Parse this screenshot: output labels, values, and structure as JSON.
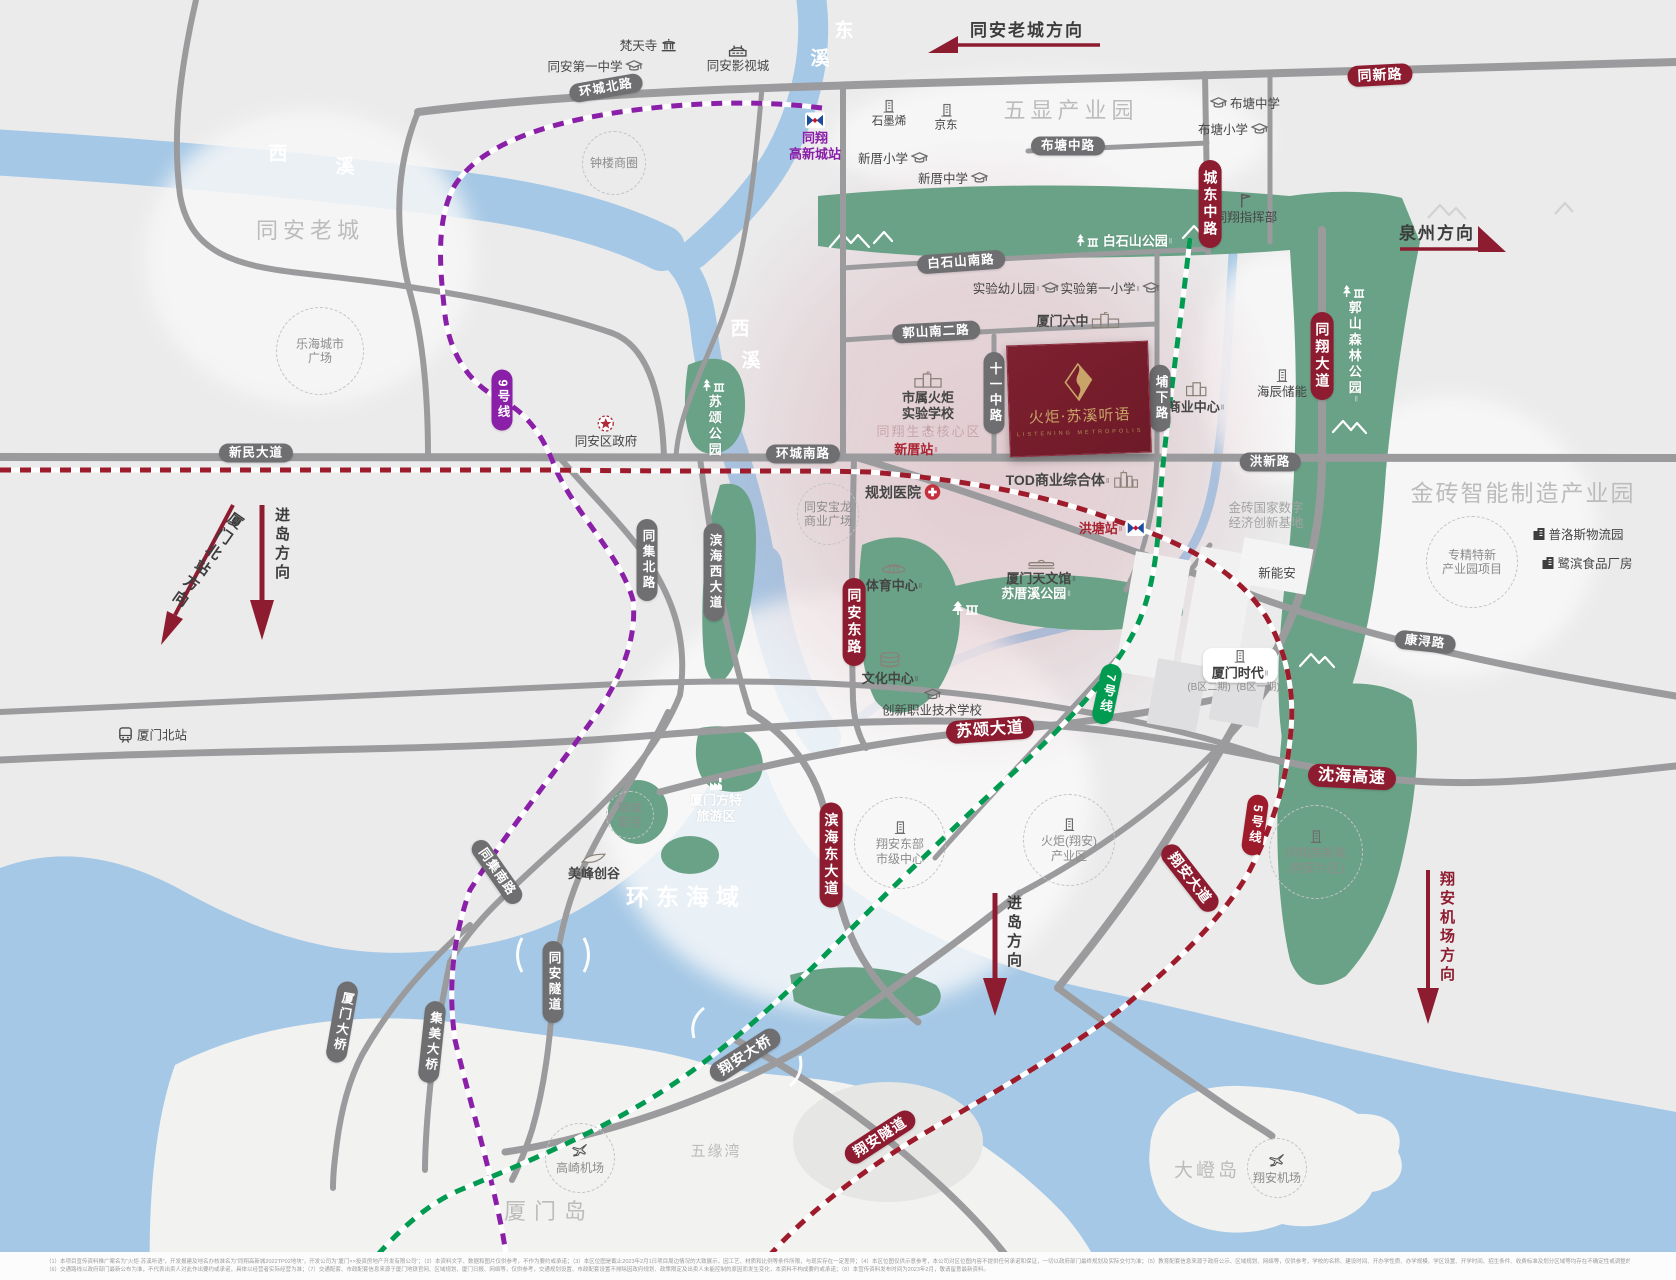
{
  "project": {
    "billboard_title": "火炬·苏溪听语",
    "billboard_subtitle": "LISTENING METROPOLIS"
  },
  "colors": {
    "accent_red": "#8E1C30",
    "road_gray": "#9B9B9D",
    "pill_gray": "#6F6F72",
    "metro9_purple": "#8A1FA8",
    "metro7_green": "#009A50",
    "metro5_red": "#9E1B2B",
    "park_green": "#6AA287",
    "water_blue": "#A5C8E6",
    "pink_zone": "#CD8794"
  },
  "disclaimer": {
    "line1": "（1）本项目宣传资料推广案名为“火炬·苏溪听语”，开发报建及地名办核准名为“同翔高新城2022TP02地块”，开发公司为“厦门××投资房地产开发有限公司”；（2）本资料文字、数据和图片仅供参考，不作为要约或承诺；（3）本区位图是截止2023年2月1日项目周边情况的大致展示，因工艺、材质和比例等条件所限，与现实存在一定差异；（4）本区位图仅供示意参考，本公司对区位图内容不提供任何承诺和保证，一切以政府部门最终规划及实际交付为准；（5）教育配套信息来源于政府公示、区域规划、网络等，仅供参考，学校的名称、建设时间、开办学性质、办学规模、学区设置、开学时间、招生条件、收费标准及划分区域等均存在不确定性或调整的可能，出卖人对此不做任何承诺。",
    "line2": "（6）交通路线以政府部门最新公布为准，不代表出卖人对此作出要约或承诺，具体以经营者实际经营为准；（7）交通配套、市政配套信息来源于厦门地铁官网、区域规划、厦门日报、网络等，仅供参考，交通规划设置、市政配套设置不排除因政府规划、政策限定及出卖人未能控制的原因而发生变化，本资料不构成要约或承诺；（8）本宣传资料发布时间为2023年2月，敬请留意最新资料。"
  },
  "labels": [
    {
      "name": "river-xixi-char1",
      "t": "西",
      "x": 278,
      "y": 155,
      "cls": "riverchar"
    },
    {
      "name": "river-xixi-char2",
      "t": "溪",
      "x": 345,
      "y": 168,
      "cls": "riverchar"
    },
    {
      "name": "river-dongxi-char1",
      "t": "东",
      "x": 844,
      "y": 32,
      "cls": "riverchar"
    },
    {
      "name": "river-dongxi-char2",
      "t": "溪",
      "x": 820,
      "y": 60,
      "cls": "riverchar"
    },
    {
      "name": "river-xixi-south-char1",
      "t": "西",
      "x": 740,
      "y": 330,
      "cls": "riverchar"
    },
    {
      "name": "river-xixi-south-char2",
      "t": "溪",
      "x": 751,
      "y": 362,
      "cls": "riverchar"
    },
    {
      "name": "area-tongan-oldtown",
      "t": "同安老城",
      "x": 310,
      "y": 231,
      "cls": "arealg"
    },
    {
      "name": "area-wuxian-park",
      "t": "五显产业园",
      "x": 1071,
      "y": 111,
      "cls": "arealg"
    },
    {
      "name": "area-jinzhuan-park",
      "t": "金砖智能制造产业园",
      "x": 1523,
      "y": 494,
      "cls": "arealg",
      "fs": 23,
      "ls": 2
    },
    {
      "name": "area-huandong-bay",
      "t": "环东海域",
      "x": 686,
      "y": 898,
      "cls": "sealg"
    },
    {
      "name": "area-xiamen-island",
      "t": "厦门岛",
      "x": 549,
      "y": 1212,
      "cls": "arealg",
      "ls": 8
    },
    {
      "name": "area-dadeng-island",
      "t": "大嶝岛",
      "x": 1207,
      "y": 1172,
      "cls": "arealg",
      "fs": 19,
      "ls": 3
    },
    {
      "name": "area-wuyuan-bay",
      "t": "五缘湾",
      "x": 716,
      "y": 1152,
      "cls": "arealg",
      "fs": 15,
      "ls": 2
    },
    {
      "name": "poi-fantian-temple",
      "t": "梵天寺",
      "x": 648,
      "y": 46,
      "icon": "temple",
      "ip": "right"
    },
    {
      "name": "poi-film-city",
      "t": "同安影视城",
      "x": 738,
      "y": 59,
      "icon": "studio",
      "ip": "top"
    },
    {
      "name": "poi-tongan-no1-school",
      "t": "同安第一中学",
      "x": 595,
      "y": 67,
      "icon": "school",
      "ip": "right"
    },
    {
      "name": "station-tongxiang-hitech",
      "lines": [
        "同翔",
        "高新城站"
      ],
      "x": 815,
      "y": 137,
      "cls": "poi-purple",
      "icon": "metro",
      "ip": "top"
    },
    {
      "name": "poi-graphene",
      "t": "石墨烯",
      "x": 889,
      "y": 114,
      "cls": "sm",
      "icon": "building",
      "ip": "top"
    },
    {
      "name": "poi-jd",
      "t": "京东",
      "x": 946,
      "y": 118,
      "cls": "sm",
      "icon": "building",
      "ip": "top"
    },
    {
      "name": "poi-xincuo-primary",
      "t": "新厝小学",
      "x": 893,
      "y": 159,
      "icon": "school",
      "ip": "right"
    },
    {
      "name": "poi-xincuo-middle",
      "t": "新厝中学",
      "x": 953,
      "y": 179,
      "icon": "school",
      "ip": "right"
    },
    {
      "name": "poi-butang-middle",
      "t": "布塘中学",
      "x": 1245,
      "y": 104,
      "icon": "school",
      "ip": "left"
    },
    {
      "name": "poi-butang-primary",
      "t": "布塘小学",
      "x": 1233,
      "y": 130,
      "icon": "school",
      "ip": "right"
    },
    {
      "name": "poi-tongxiang-hq",
      "t": "同翔指挥部",
      "x": 1246,
      "y": 209,
      "icon": "flag",
      "ip": "top"
    },
    {
      "name": "poi-baishishan-park",
      "t": "白石山公园",
      "x": 1124,
      "y": 241,
      "cls": "wl",
      "icon": "park",
      "ip": "left",
      "sup": 1
    },
    {
      "name": "poi-shiyan-kindergarten",
      "t": "实验幼儿园",
      "x": 1016,
      "y": 289,
      "icon": "school",
      "ip": "right",
      "sup": 1
    },
    {
      "name": "poi-shiyan-first-primary",
      "t": "实验第一小学",
      "x": 1110,
      "y": 289,
      "icon": "school",
      "ip": "right",
      "sup": 1
    },
    {
      "name": "poi-xiamen-no6",
      "t": "厦门六中",
      "x": 1078,
      "y": 321,
      "cls": "b",
      "icon": "schoolbldg",
      "ip": "right"
    },
    {
      "name": "poi-torch-school",
      "lines": [
        "市属火炬",
        "实验学校"
      ],
      "x": 928,
      "y": 404,
      "cls": "b",
      "icon": "schoolbldg",
      "ip": "top",
      "sup": 1
    },
    {
      "name": "label-eco-core",
      "t": "同翔生态核心区",
      "x": 929,
      "y": 432,
      "cls": "core"
    },
    {
      "name": "station-xincuo",
      "t": "新厝站",
      "x": 916,
      "y": 450,
      "cls": "station",
      "sup": 1
    },
    {
      "name": "poi-business-center",
      "t": "商业中心",
      "x": 1196,
      "y": 398,
      "cls": "b",
      "icon": "building2",
      "ip": "top",
      "sup": 1
    },
    {
      "name": "poi-haichen-storage",
      "t": "海辰储能",
      "x": 1282,
      "y": 384,
      "icon": "building",
      "ip": "top"
    },
    {
      "name": "poi-guoshan-forest-park",
      "t": "郭山森林公园",
      "x": 1354,
      "y": 345,
      "cls": "wl v",
      "icon": "park",
      "ip": "top",
      "sup": 1
    },
    {
      "name": "poi-susong-park",
      "t": "苏颂公园",
      "x": 714,
      "y": 418,
      "cls": "wl v",
      "icon": "park",
      "ip": "top"
    },
    {
      "name": "poi-tod-complex",
      "t": "TOD商业综合体",
      "x": 1072,
      "y": 480,
      "cls": "b",
      "fs": 14,
      "icon": "tod",
      "ip": "right",
      "sup": 1
    },
    {
      "name": "station-hongtang",
      "t": "洪塘站",
      "x": 1112,
      "y": 529,
      "cls": "station",
      "icon": "metro",
      "ip": "right",
      "sup": 1
    },
    {
      "name": "poi-planned-hospital",
      "t": "规划医院",
      "x": 903,
      "y": 493,
      "cls": "b",
      "fs": 14,
      "icon": "cross",
      "ip": "right"
    },
    {
      "name": "poi-sports-center",
      "t": "体育中心",
      "x": 894,
      "y": 577,
      "cls": "b",
      "icon": "stadium",
      "ip": "top",
      "sup": 1
    },
    {
      "name": "poi-planetarium",
      "t": "厦门天文馆",
      "x": 1041,
      "y": 572,
      "cls": "b",
      "icon": "observatory",
      "ip": "top",
      "sup": 1
    },
    {
      "name": "poi-sucuoxi-park",
      "t": "苏厝溪公园",
      "x": 1036,
      "y": 594,
      "cls": "wl",
      "sup": 1
    },
    {
      "name": "poi-culture-center",
      "t": "文化中心",
      "x": 890,
      "y": 669,
      "cls": "b",
      "icon": "cylinder",
      "ip": "top",
      "sup": 1
    },
    {
      "name": "poi-vocational-school",
      "t": "创新职业技术学校",
      "x": 932,
      "y": 703,
      "icon": "school",
      "ip": "top"
    },
    {
      "name": "label-brics-base",
      "lines": [
        "金砖国家数字",
        "经济创新基地"
      ],
      "x": 1266,
      "y": 516,
      "cls": "ghost"
    },
    {
      "name": "poi-prologis",
      "t": "普洛斯物流园",
      "x": 1578,
      "y": 535,
      "icon": "bdark",
      "ip": "left"
    },
    {
      "name": "poi-lubin-food",
      "t": "鹭滨食品厂房",
      "x": 1587,
      "y": 564,
      "icon": "bdark",
      "ip": "left"
    },
    {
      "name": "poi-xinnengan",
      "t": "新能安",
      "x": 1277,
      "y": 574
    },
    {
      "name": "poi-xiamen-times",
      "t": "厦门时代",
      "x": 1240,
      "y": 665,
      "cls": "whpill",
      "icon": "building",
      "ip": "top",
      "sup": 1
    },
    {
      "name": "label-b-zone-2",
      "t": "(B区二期)",
      "x": 1209,
      "y": 688,
      "cls": "tinyg"
    },
    {
      "name": "label-b-zone-1",
      "t": "(B区一期)",
      "x": 1258,
      "y": 688,
      "cls": "tinyg"
    },
    {
      "name": "poi-district-gov",
      "t": "同安区政府",
      "x": 606,
      "y": 432,
      "icon": "star",
      "ip": "top"
    },
    {
      "name": "poi-xiamen-north-station",
      "t": "厦门北站",
      "x": 152,
      "y": 736,
      "icon": "train",
      "ip": "left"
    },
    {
      "name": "poi-meifeng-valley",
      "t": "美峰创谷",
      "x": 594,
      "y": 867,
      "cls": "b",
      "icon": "trowel",
      "ip": "top"
    },
    {
      "name": "poi-fantawild",
      "lines": [
        "厦门方特",
        "旅游区"
      ],
      "x": 716,
      "y": 800,
      "cls": "wl",
      "icon": "factoryw",
      "ip": "top"
    },
    {
      "name": "circle-lehai-plaza",
      "lines": [
        "乐海城市",
        "广场"
      ],
      "x": 320,
      "y": 351,
      "cls": "circle",
      "r": 43
    },
    {
      "name": "circle-zhonglou",
      "t": "钟楼商圈",
      "x": 614,
      "y": 163,
      "cls": "circle",
      "r": 31
    },
    {
      "name": "circle-baolong-plaza",
      "lines": [
        "同安宝龙",
        "商业广场"
      ],
      "x": 828,
      "y": 514,
      "cls": "circle",
      "r": 30
    },
    {
      "name": "circle-specialized-park",
      "lines": [
        "专精特新",
        "产业园项目"
      ],
      "x": 1472,
      "y": 562,
      "cls": "circle",
      "r": 45
    },
    {
      "name": "circle-yincheng",
      "lines": [
        "银城",
        "智谷"
      ],
      "x": 630,
      "y": 815,
      "cls": "circle",
      "r": 23
    },
    {
      "name": "circle-xiangan-east-center",
      "lines": [
        "翔安东部",
        "市级中心"
      ],
      "x": 900,
      "y": 843,
      "cls": "circle",
      "r": 45,
      "icon": "building"
    },
    {
      "name": "circle-torch-xiangan",
      "lines": [
        "火炬(翔安)",
        "产业区"
      ],
      "x": 1069,
      "y": 840,
      "cls": "circle",
      "r": 45,
      "icon": "building"
    },
    {
      "name": "circle-tongxiang-xiangan",
      "lines": [
        "同翔高新城",
        "(翔安片区)"
      ],
      "x": 1316,
      "y": 852,
      "cls": "circle",
      "r": 46,
      "icon": "building"
    },
    {
      "name": "circle-gaoqi-airport",
      "t": "高崎机场",
      "x": 580,
      "y": 1158,
      "cls": "circle",
      "r": 34,
      "icon": "plane"
    },
    {
      "name": "circle-xiangan-airport",
      "t": "翔安机场",
      "x": 1277,
      "y": 1168,
      "cls": "circle",
      "r": 29,
      "icon": "plane"
    },
    {
      "name": "pill-huanchengbei-rd",
      "t": "环城北路",
      "x": 606,
      "y": 88,
      "cls": "pill",
      "rot": -10
    },
    {
      "name": "pill-butangzhong-rd",
      "t": "布塘中路",
      "x": 1068,
      "y": 146,
      "cls": "pill"
    },
    {
      "name": "pill-tongxin-rd",
      "t": "同新路",
      "x": 1380,
      "y": 75,
      "cls": "pill r",
      "rot": -3
    },
    {
      "name": "pill-chengdongzhong-rd",
      "t": "城东中路",
      "x": 1210,
      "y": 204,
      "cls": "pill r v"
    },
    {
      "name": "pill-baishishannan-rd",
      "t": "白石山南路",
      "x": 961,
      "y": 262,
      "cls": "pill",
      "rot": -4
    },
    {
      "name": "pill-guoshannan2-rd",
      "t": "郭山南二路",
      "x": 936,
      "y": 332,
      "cls": "pill",
      "rot": -3
    },
    {
      "name": "pill-shiyizhong-rd",
      "t": "十一中路",
      "x": 994,
      "y": 393,
      "cls": "pill v"
    },
    {
      "name": "pill-puxia-rd",
      "t": "埔下路",
      "x": 1160,
      "y": 398,
      "cls": "pill v"
    },
    {
      "name": "pill-tongxiang-ave",
      "t": "同翔大道",
      "x": 1322,
      "y": 356,
      "cls": "pill r v"
    },
    {
      "name": "pill-hongxin-rd",
      "t": "洪新路",
      "x": 1270,
      "y": 462,
      "cls": "pill"
    },
    {
      "name": "pill-huanchengnan-rd",
      "t": "环城南路",
      "x": 803,
      "y": 454,
      "cls": "pill"
    },
    {
      "name": "pill-xinmin-ave",
      "t": "新民大道",
      "x": 256,
      "y": 453,
      "cls": "pill"
    },
    {
      "name": "pill-metro-line9",
      "t": "9号线",
      "x": 502,
      "y": 400,
      "cls": "pill m9 v"
    },
    {
      "name": "pill-tongjibei-rd",
      "t": "同集北路",
      "x": 647,
      "y": 560,
      "cls": "pill v"
    },
    {
      "name": "pill-binhaixi-ave",
      "t": "滨海西大道",
      "x": 714,
      "y": 572,
      "cls": "pill v"
    },
    {
      "name": "pill-tongandong-rd",
      "t": "同安东路",
      "x": 854,
      "y": 622,
      "cls": "pill r v"
    },
    {
      "name": "pill-kangxun-rd",
      "t": "康浔路",
      "x": 1425,
      "y": 642,
      "cls": "pill",
      "rot": 6
    },
    {
      "name": "pill-susong-ave",
      "t": "苏颂大道",
      "x": 990,
      "y": 730,
      "cls": "pill r",
      "rot": -4,
      "fs": 16
    },
    {
      "name": "pill-metro-line7",
      "t": "7号线",
      "x": 1107,
      "y": 694,
      "cls": "pill m7 v",
      "rot": 12
    },
    {
      "name": "pill-shenhai-expwy",
      "t": "沈海高速",
      "x": 1352,
      "y": 777,
      "cls": "pill r",
      "rot": 3,
      "fs": 16
    },
    {
      "name": "pill-metro-line5",
      "t": "5号线",
      "x": 1255,
      "y": 825,
      "cls": "pill m5 v",
      "rot": 8
    },
    {
      "name": "pill-xiangan-ave",
      "t": "翔安大道",
      "x": 1190,
      "y": 878,
      "cls": "pill r",
      "rot": 52
    },
    {
      "name": "pill-binhaidong-ave",
      "t": "滨海东大道",
      "x": 831,
      "y": 855,
      "cls": "pill r v"
    },
    {
      "name": "pill-tongjinan-rd",
      "t": "同集南路",
      "x": 497,
      "y": 872,
      "cls": "pill",
      "rot": 55
    },
    {
      "name": "pill-tongan-tunnel",
      "t": "同安隧道",
      "x": 553,
      "y": 982,
      "cls": "pill v"
    },
    {
      "name": "pill-xiamen-bridge",
      "t": "厦门大桥",
      "x": 342,
      "y": 1022,
      "cls": "pill v",
      "rot": 10
    },
    {
      "name": "pill-jimei-bridge",
      "t": "集美大桥",
      "x": 432,
      "y": 1042,
      "cls": "pill v",
      "rot": 6
    },
    {
      "name": "pill-xiangan-bridge",
      "t": "翔安大桥",
      "x": 745,
      "y": 1055,
      "cls": "pill",
      "rot": -33,
      "fs": 14
    },
    {
      "name": "pill-xiangan-tunnel",
      "t": "翔安隧道",
      "x": 880,
      "y": 1137,
      "cls": "pill r",
      "rot": -33
    },
    {
      "name": "dir-tongan-oldtown",
      "t": "同安老城方向",
      "x": 1027,
      "y": 31,
      "cls": "dirh"
    },
    {
      "name": "dir-quanzhou",
      "t": "泉州方向",
      "x": 1437,
      "y": 234,
      "cls": "dirh"
    },
    {
      "name": "dir-xiamen-north",
      "t": "厦门北站方向",
      "x": 206,
      "y": 560,
      "cls": "dirv",
      "rot": 35
    },
    {
      "name": "dir-island-west",
      "t": "进岛方向",
      "x": 281,
      "y": 545,
      "cls": "dirv"
    },
    {
      "name": "dir-island-center",
      "t": "进岛方向",
      "x": 1013,
      "y": 933,
      "cls": "dirv"
    },
    {
      "name": "dir-xiangan-airport",
      "t": "翔安机场方向",
      "x": 1446,
      "y": 928,
      "cls": "dirv dirred"
    }
  ]
}
